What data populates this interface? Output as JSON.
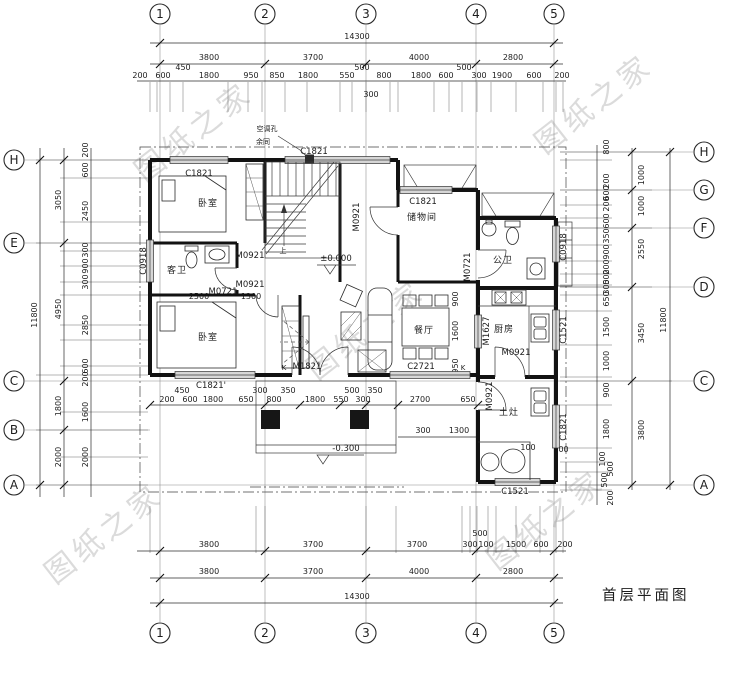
{
  "title": "首层平面图",
  "watermark": "图纸之家",
  "axes": {
    "cols": [
      "1",
      "2",
      "3",
      "4",
      "5"
    ],
    "rows_left": [
      "H",
      "E",
      "C",
      "B",
      "A"
    ],
    "rows_right": [
      "H",
      "G",
      "F",
      "D",
      "C",
      "A"
    ]
  },
  "dims": {
    "top": {
      "total": "14300",
      "major": [
        "3800",
        "3700",
        "4000",
        "2800"
      ],
      "minor": [
        "200",
        "600",
        "450",
        "1800",
        "950",
        "850",
        "1800",
        "550",
        "500",
        "800",
        "300",
        "1800",
        "600",
        "500",
        "300",
        "1900",
        "600",
        "200"
      ]
    },
    "bottom": {
      "row1": [
        "3800",
        "3700",
        "3700",
        "300",
        "100",
        "500",
        "1500",
        "600",
        "200"
      ],
      "major": [
        "3800",
        "3700",
        "4000",
        "2800"
      ],
      "total": "14300"
    },
    "left": {
      "total": "11800",
      "major": [
        "3050",
        "4950",
        "1800",
        "2000"
      ],
      "minor": [
        "200",
        "600",
        "2450",
        "300",
        "900",
        "300",
        "2850",
        "600",
        "200",
        "1600",
        "2000"
      ]
    },
    "right": {
      "total": "11800",
      "major": [
        "1000",
        "1000",
        "2550",
        "3450",
        "3800"
      ],
      "minor": [
        "800",
        "200",
        "600",
        "200",
        "600",
        "350",
        "900",
        "200",
        "500",
        "300",
        "650",
        "1500",
        "1000",
        "900",
        "1800",
        "100",
        "500",
        "500",
        "200"
      ]
    },
    "mid": [
      "200",
      "600",
      "450",
      "1800",
      "650",
      "300",
      "800",
      "350",
      "1800",
      "550",
      "500",
      "300",
      "350",
      "2700",
      "650"
    ],
    "inner": {
      "b2500": "2500",
      "b1300": "1300",
      "din900": "900",
      "din1600": "1600",
      "din950": "950",
      "porch300": "300",
      "porch1300": "1300",
      "stove100": "100",
      "stove500": "500"
    }
  },
  "rooms": {
    "bedroom1": "卧室",
    "bedroom2": "卧室",
    "guest_bath": "客卫",
    "storage": "储物间",
    "dining": "餐厅",
    "public_bath": "公卫",
    "kitchen": "厨房",
    "stove_room": "土灶"
  },
  "openings": {
    "c1821": "C1821",
    "c1821p": "C1821'",
    "c0918": "C0918",
    "c2721": "C2721",
    "c1521": "C1521",
    "m0921": "M0921",
    "m0721": "M0721",
    "m1821": "M1821",
    "m1627": "M1627"
  },
  "notes": {
    "ac_hole": "空调孔",
    "ac_rest": "余同",
    "up": "上",
    "k": "K",
    "level_main": "±0.000",
    "level_porch": "-0.300"
  }
}
